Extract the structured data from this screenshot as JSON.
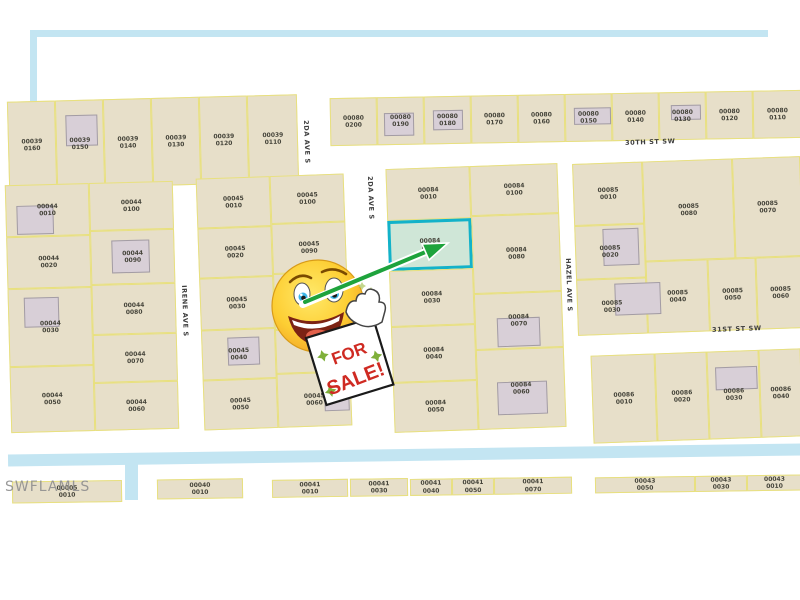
{
  "watermark": "SWFLAMLS",
  "sale_sign": {
    "line1": "FOR",
    "line2": "SALE!"
  },
  "colors": {
    "parcel_fill": "#e7dfc9",
    "lot_line": "#e8e07e",
    "building_fill": "#d8cfd7",
    "highlight_fill": "#cfe6d7",
    "highlight_border": "#12b2c9",
    "canal_blue": "#c3e5f2",
    "arrow_green": "#1ea33c",
    "sign_red": "#cf2a22",
    "star_green": "#7fb03a"
  },
  "highlighted_parcel_label": "00084 0020",
  "streets": [
    {
      "label": "30TH ST SW",
      "x": 625,
      "y": 138,
      "rot": -2,
      "vertical": false
    },
    {
      "label": "31ST ST SW",
      "x": 712,
      "y": 325,
      "rot": -2,
      "vertical": false
    },
    {
      "label": "2DA AVE S",
      "x": 310,
      "y": 120,
      "rot": 0,
      "vertical": true
    },
    {
      "label": "2DA AVE S",
      "x": 374,
      "y": 176,
      "rot": 0,
      "vertical": true
    },
    {
      "label": "IRENE AVE S",
      "x": 188,
      "y": 285,
      "rot": 0,
      "vertical": true
    },
    {
      "label": "HAZEL AVE S",
      "x": 572,
      "y": 258,
      "rot": 0,
      "vertical": true
    }
  ],
  "canals": [
    {
      "x": 8,
      "y": 449,
      "w": 794,
      "h": 12,
      "rot": -0.8
    },
    {
      "x": 125,
      "y": 458,
      "w": 13,
      "h": 42,
      "rot": 0
    },
    {
      "x": 30,
      "y": 30,
      "w": 738,
      "h": 7,
      "rot": 0
    },
    {
      "x": 30,
      "y": 30,
      "w": 7,
      "h": 88,
      "rot": 0
    }
  ],
  "blocks": [
    {
      "name": "00039",
      "x": 8,
      "y": 96,
      "w": 290,
      "h": 92,
      "rot": -1.5,
      "parcels": [
        {
          "label": "00039 0160",
          "x": 0,
          "y": 2,
          "w": 48,
          "h": 88
        },
        {
          "label": "00039 0150",
          "x": 48,
          "y": 2,
          "w": 48,
          "h": 88,
          "building": {
            "x": 9,
            "y": 14,
            "w": 32,
            "h": 31
          }
        },
        {
          "label": "00039 0140",
          "x": 96,
          "y": 2,
          "w": 48,
          "h": 88
        },
        {
          "label": "00039 0130",
          "x": 144,
          "y": 2,
          "w": 48,
          "h": 88
        },
        {
          "label": "00039 0120",
          "x": 192,
          "y": 2,
          "w": 48,
          "h": 88
        },
        {
          "label": "00039 0110",
          "x": 240,
          "y": 2,
          "w": 50,
          "h": 88
        }
      ]
    },
    {
      "name": "00080",
      "x": 330,
      "y": 94,
      "w": 472,
      "h": 48,
      "rot": -1,
      "parcels": [
        {
          "label": "00080 0200",
          "x": 0,
          "y": 0,
          "w": 47,
          "h": 48
        },
        {
          "label": "00080 0190",
          "x": 47,
          "y": 0,
          "w": 47,
          "h": 48,
          "building": {
            "x": 6,
            "y": 15,
            "w": 30,
            "h": 23
          }
        },
        {
          "label": "00080 0180",
          "x": 94,
          "y": 0,
          "w": 47,
          "h": 48,
          "building": {
            "x": 8,
            "y": 13,
            "w": 30,
            "h": 20
          }
        },
        {
          "label": "00080 0170",
          "x": 141,
          "y": 0,
          "w": 47,
          "h": 48
        },
        {
          "label": "00080 0160",
          "x": 188,
          "y": 0,
          "w": 47,
          "h": 48
        },
        {
          "label": "00080 0150",
          "x": 235,
          "y": 0,
          "w": 47,
          "h": 48,
          "building": {
            "x": 8,
            "y": 13,
            "w": 37,
            "h": 17
          }
        },
        {
          "label": "00080 0140",
          "x": 282,
          "y": 0,
          "w": 47,
          "h": 48
        },
        {
          "label": "00080 0130",
          "x": 329,
          "y": 0,
          "w": 47,
          "h": 48,
          "building": {
            "x": 11,
            "y": 12,
            "w": 30,
            "h": 15
          }
        },
        {
          "label": "00080 0120",
          "x": 376,
          "y": 0,
          "w": 47,
          "h": 48
        },
        {
          "label": "00080 0110",
          "x": 423,
          "y": 0,
          "w": 49,
          "h": 48
        }
      ]
    },
    {
      "name": "00044",
      "x": 8,
      "y": 183,
      "w": 168,
      "h": 248,
      "rot": -1.5,
      "parcels": [
        {
          "label": "00044 0010",
          "x": 0,
          "y": 0,
          "w": 84,
          "h": 52,
          "building": {
            "x": 10,
            "y": 20,
            "w": 37,
            "h": 29
          }
        },
        {
          "label": "00044 0020",
          "x": 0,
          "y": 52,
          "w": 84,
          "h": 52
        },
        {
          "label": "00044 0030",
          "x": 0,
          "y": 104,
          "w": 84,
          "h": 78,
          "building": {
            "x": 15,
            "y": 8,
            "w": 35,
            "h": 30
          }
        },
        {
          "label": "00044 0050",
          "x": 0,
          "y": 182,
          "w": 84,
          "h": 66
        },
        {
          "label": "00044 0100",
          "x": 84,
          "y": 0,
          "w": 84,
          "h": 48
        },
        {
          "label": "00044 0090",
          "x": 84,
          "y": 48,
          "w": 84,
          "h": 54,
          "building": {
            "x": 20,
            "y": 9,
            "w": 38,
            "h": 33
          }
        },
        {
          "label": "00044 0080",
          "x": 84,
          "y": 102,
          "w": 84,
          "h": 50
        },
        {
          "label": "00044 0070",
          "x": 84,
          "y": 152,
          "w": 84,
          "h": 48
        },
        {
          "label": "00044 0060",
          "x": 84,
          "y": 200,
          "w": 84,
          "h": 48
        }
      ]
    },
    {
      "name": "00045",
      "x": 200,
      "y": 176,
      "w": 148,
      "h": 252,
      "rot": -2,
      "parcels": [
        {
          "label": "00045 0010",
          "x": 0,
          "y": 0,
          "w": 74,
          "h": 50
        },
        {
          "label": "00045 0020",
          "x": 0,
          "y": 50,
          "w": 74,
          "h": 50
        },
        {
          "label": "00045 0030",
          "x": 0,
          "y": 100,
          "w": 74,
          "h": 52
        },
        {
          "label": "00045 0040",
          "x": 0,
          "y": 152,
          "w": 74,
          "h": 50,
          "building": {
            "x": 25,
            "y": 7,
            "w": 32,
            "h": 28
          }
        },
        {
          "label": "00045 0050",
          "x": 0,
          "y": 202,
          "w": 74,
          "h": 50
        },
        {
          "label": "00045 0100",
          "x": 74,
          "y": 0,
          "w": 74,
          "h": 48
        },
        {
          "label": "00045 0090",
          "x": 74,
          "y": 48,
          "w": 74,
          "h": 50
        },
        {
          "label": "",
          "x": 74,
          "y": 98,
          "w": 74,
          "h": 56
        },
        {
          "label": "",
          "x": 74,
          "y": 154,
          "w": 74,
          "h": 44
        },
        {
          "label": "00045 0060",
          "x": 74,
          "y": 198,
          "w": 74,
          "h": 54,
          "building": {
            "x": 46,
            "y": 14,
            "w": 25,
            "h": 24
          }
        }
      ]
    },
    {
      "name": "00084",
      "x": 390,
      "y": 166,
      "w": 172,
      "h": 264,
      "rot": -2,
      "parcels": [
        {
          "label": "00084 0010",
          "x": 0,
          "y": 0,
          "w": 84,
          "h": 52
        },
        {
          "label": "00084 0020",
          "x": 0,
          "y": 52,
          "w": 84,
          "h": 50,
          "highlight": true
        },
        {
          "label": "00084 0030",
          "x": 0,
          "y": 102,
          "w": 84,
          "h": 56
        },
        {
          "label": "00084 0040",
          "x": 0,
          "y": 158,
          "w": 84,
          "h": 56
        },
        {
          "label": "00084 0050",
          "x": 0,
          "y": 214,
          "w": 84,
          "h": 50
        },
        {
          "label": "00084 0100",
          "x": 84,
          "y": 0,
          "w": 88,
          "h": 50
        },
        {
          "label": "00084 0080",
          "x": 84,
          "y": 50,
          "w": 88,
          "h": 78
        },
        {
          "label": "00084 0070",
          "x": 84,
          "y": 128,
          "w": 88,
          "h": 56,
          "building": {
            "x": 21,
            "y": 24,
            "w": 43,
            "h": 29
          }
        },
        {
          "label": "00084 0060",
          "x": 84,
          "y": 184,
          "w": 88,
          "h": 80,
          "building": {
            "x": 19,
            "y": 32,
            "w": 50,
            "h": 33
          }
        }
      ]
    },
    {
      "name": "00085",
      "x": 575,
      "y": 160,
      "w": 228,
      "h": 172,
      "rot": -2,
      "parcels": [
        {
          "label": "00085 0010",
          "x": 0,
          "y": 0,
          "w": 70,
          "h": 62
        },
        {
          "label": "00085 0020",
          "x": 0,
          "y": 62,
          "w": 70,
          "h": 54,
          "building": {
            "x": 27,
            "y": 3,
            "w": 36,
            "h": 37
          }
        },
        {
          "label": "00085 0030",
          "x": 0,
          "y": 116,
          "w": 70,
          "h": 56,
          "building": {
            "x": 37,
            "y": 4,
            "w": 46,
            "h": 32
          }
        },
        {
          "label": "00085 0080",
          "x": 70,
          "y": 0,
          "w": 90,
          "h": 100
        },
        {
          "label": "00085 0070",
          "x": 160,
          "y": 0,
          "w": 68,
          "h": 100
        },
        {
          "label": "00085 0040",
          "x": 70,
          "y": 100,
          "w": 62,
          "h": 72
        },
        {
          "label": "00085 0050",
          "x": 132,
          "y": 100,
          "w": 48,
          "h": 72
        },
        {
          "label": "00085 0060",
          "x": 180,
          "y": 100,
          "w": 48,
          "h": 72
        }
      ]
    },
    {
      "name": "00086",
      "x": 592,
      "y": 352,
      "w": 210,
      "h": 88,
      "rot": -2,
      "parcels": [
        {
          "label": "00086 0010",
          "x": 0,
          "y": 0,
          "w": 64,
          "h": 88
        },
        {
          "label": "00086 0020",
          "x": 64,
          "y": 0,
          "w": 52,
          "h": 88
        },
        {
          "label": "00086 0030",
          "x": 116,
          "y": 0,
          "w": 52,
          "h": 88,
          "building": {
            "x": 7,
            "y": 15,
            "w": 42,
            "h": 23
          }
        },
        {
          "label": "00086 0040",
          "x": 168,
          "y": 0,
          "w": 42,
          "h": 88
        }
      ]
    },
    {
      "name": "canal-row",
      "x": 10,
      "y": 472,
      "w": 792,
      "h": 28,
      "rot": -0.8,
      "parcels": [
        {
          "label": "00005 0010",
          "x": 2,
          "y": 4,
          "w": 110,
          "h": 22
        },
        {
          "label": "00040 0010",
          "x": 147,
          "y": 4,
          "w": 86,
          "h": 20
        },
        {
          "label": "00041 0010",
          "x": 262,
          "y": 6,
          "w": 76,
          "h": 18
        },
        {
          "label": "00041 0030",
          "x": 340,
          "y": 6,
          "w": 58,
          "h": 18
        },
        {
          "label": "00041 0040",
          "x": 400,
          "y": 7,
          "w": 42,
          "h": 17
        },
        {
          "label": "00041 0050",
          "x": 442,
          "y": 7,
          "w": 42,
          "h": 17
        },
        {
          "label": "00041 0070",
          "x": 484,
          "y": 7,
          "w": 78,
          "h": 17
        },
        {
          "label": "00043 0050",
          "x": 585,
          "y": 8,
          "w": 100,
          "h": 16
        },
        {
          "label": "00043 0030",
          "x": 685,
          "y": 8,
          "w": 52,
          "h": 16
        },
        {
          "label": "00043 0010",
          "x": 737,
          "y": 8,
          "w": 55,
          "h": 16
        }
      ]
    }
  ]
}
